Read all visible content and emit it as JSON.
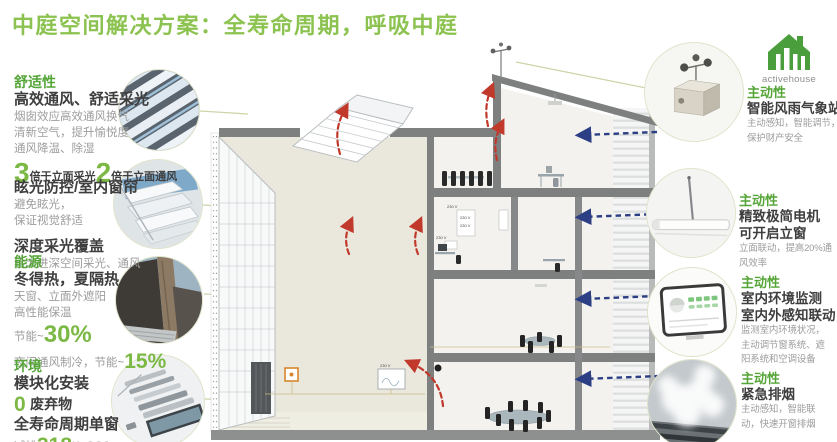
{
  "title": "中庭空间解决方案：全寿命周期，呼吸中庭",
  "logo": {
    "text": "activehouse"
  },
  "left": {
    "s1": {
      "category": "舒适性",
      "heading": "高效通风、舒适采光",
      "line1": "烟囱效应高效通风换气",
      "line2": "清新空气，提升愉悦度",
      "line3": "通风降温、除湿",
      "m1_big": "3",
      "m1_label": "倍于立面采光",
      "m2_big": "2",
      "m2_label": "倍于立面通风"
    },
    "s2": {
      "heading1": "眩光防控/室内窗帘",
      "line1": "避免眩光，",
      "line2": "保证视觉舒适",
      "heading2": "深度采光覆盖",
      "line3": "给大进深空间采光、通风"
    },
    "s3": {
      "category": "能源",
      "heading": "冬得热，夏隔热",
      "line1": "天窗、立面外遮阳",
      "line2": "高性能保温",
      "m1_prefix": "节能~",
      "m1_big": "30%",
      "m2_prefix": "夜间通风制冷，节能~",
      "m2_big": "15%"
    },
    "s4": {
      "category": "环境",
      "heading": "模块化安装",
      "m0_big": "0",
      "m0_label": "废弃物",
      "heading2": "全寿命周期单窗",
      "m1_prefix": "减排",
      "m1_big": "318",
      "m1_suffix": "KgCO2"
    }
  },
  "right": {
    "s1": {
      "category": "主动性",
      "heading": "智能风雨气象站",
      "line1": "主动感知，智能调节，",
      "line2": "保护财产安全"
    },
    "s2": {
      "category": "主动性",
      "heading1": "精致极简电机",
      "heading2": "可开启立窗",
      "line1": "立面联动，提高20%通",
      "line2": "风效率"
    },
    "s3": {
      "category": "主动性",
      "heading1": "室内环境监测",
      "heading2": "室内外感知联动",
      "line1": "监测室内环境状况，",
      "line2": "主动调节窗系统、遮",
      "line3": "阳系统和空调设备"
    },
    "s4": {
      "category": "主动性",
      "heading": "紧急排烟",
      "line1": "主动感知，智能联",
      "line2": "动，快速开窗排烟"
    }
  },
  "diagram": {
    "voltage_label": "230 V"
  },
  "palette": {
    "title_green": "#8cc350",
    "category_green": "#55a538",
    "number_green": "#7cb944",
    "heading_dark": "#3e3e3e",
    "body_gray": "#9c9c9c",
    "arrow_red": "#c0392b",
    "arrow_blue": "#2c3f85",
    "orange_box": "#d7862c"
  }
}
